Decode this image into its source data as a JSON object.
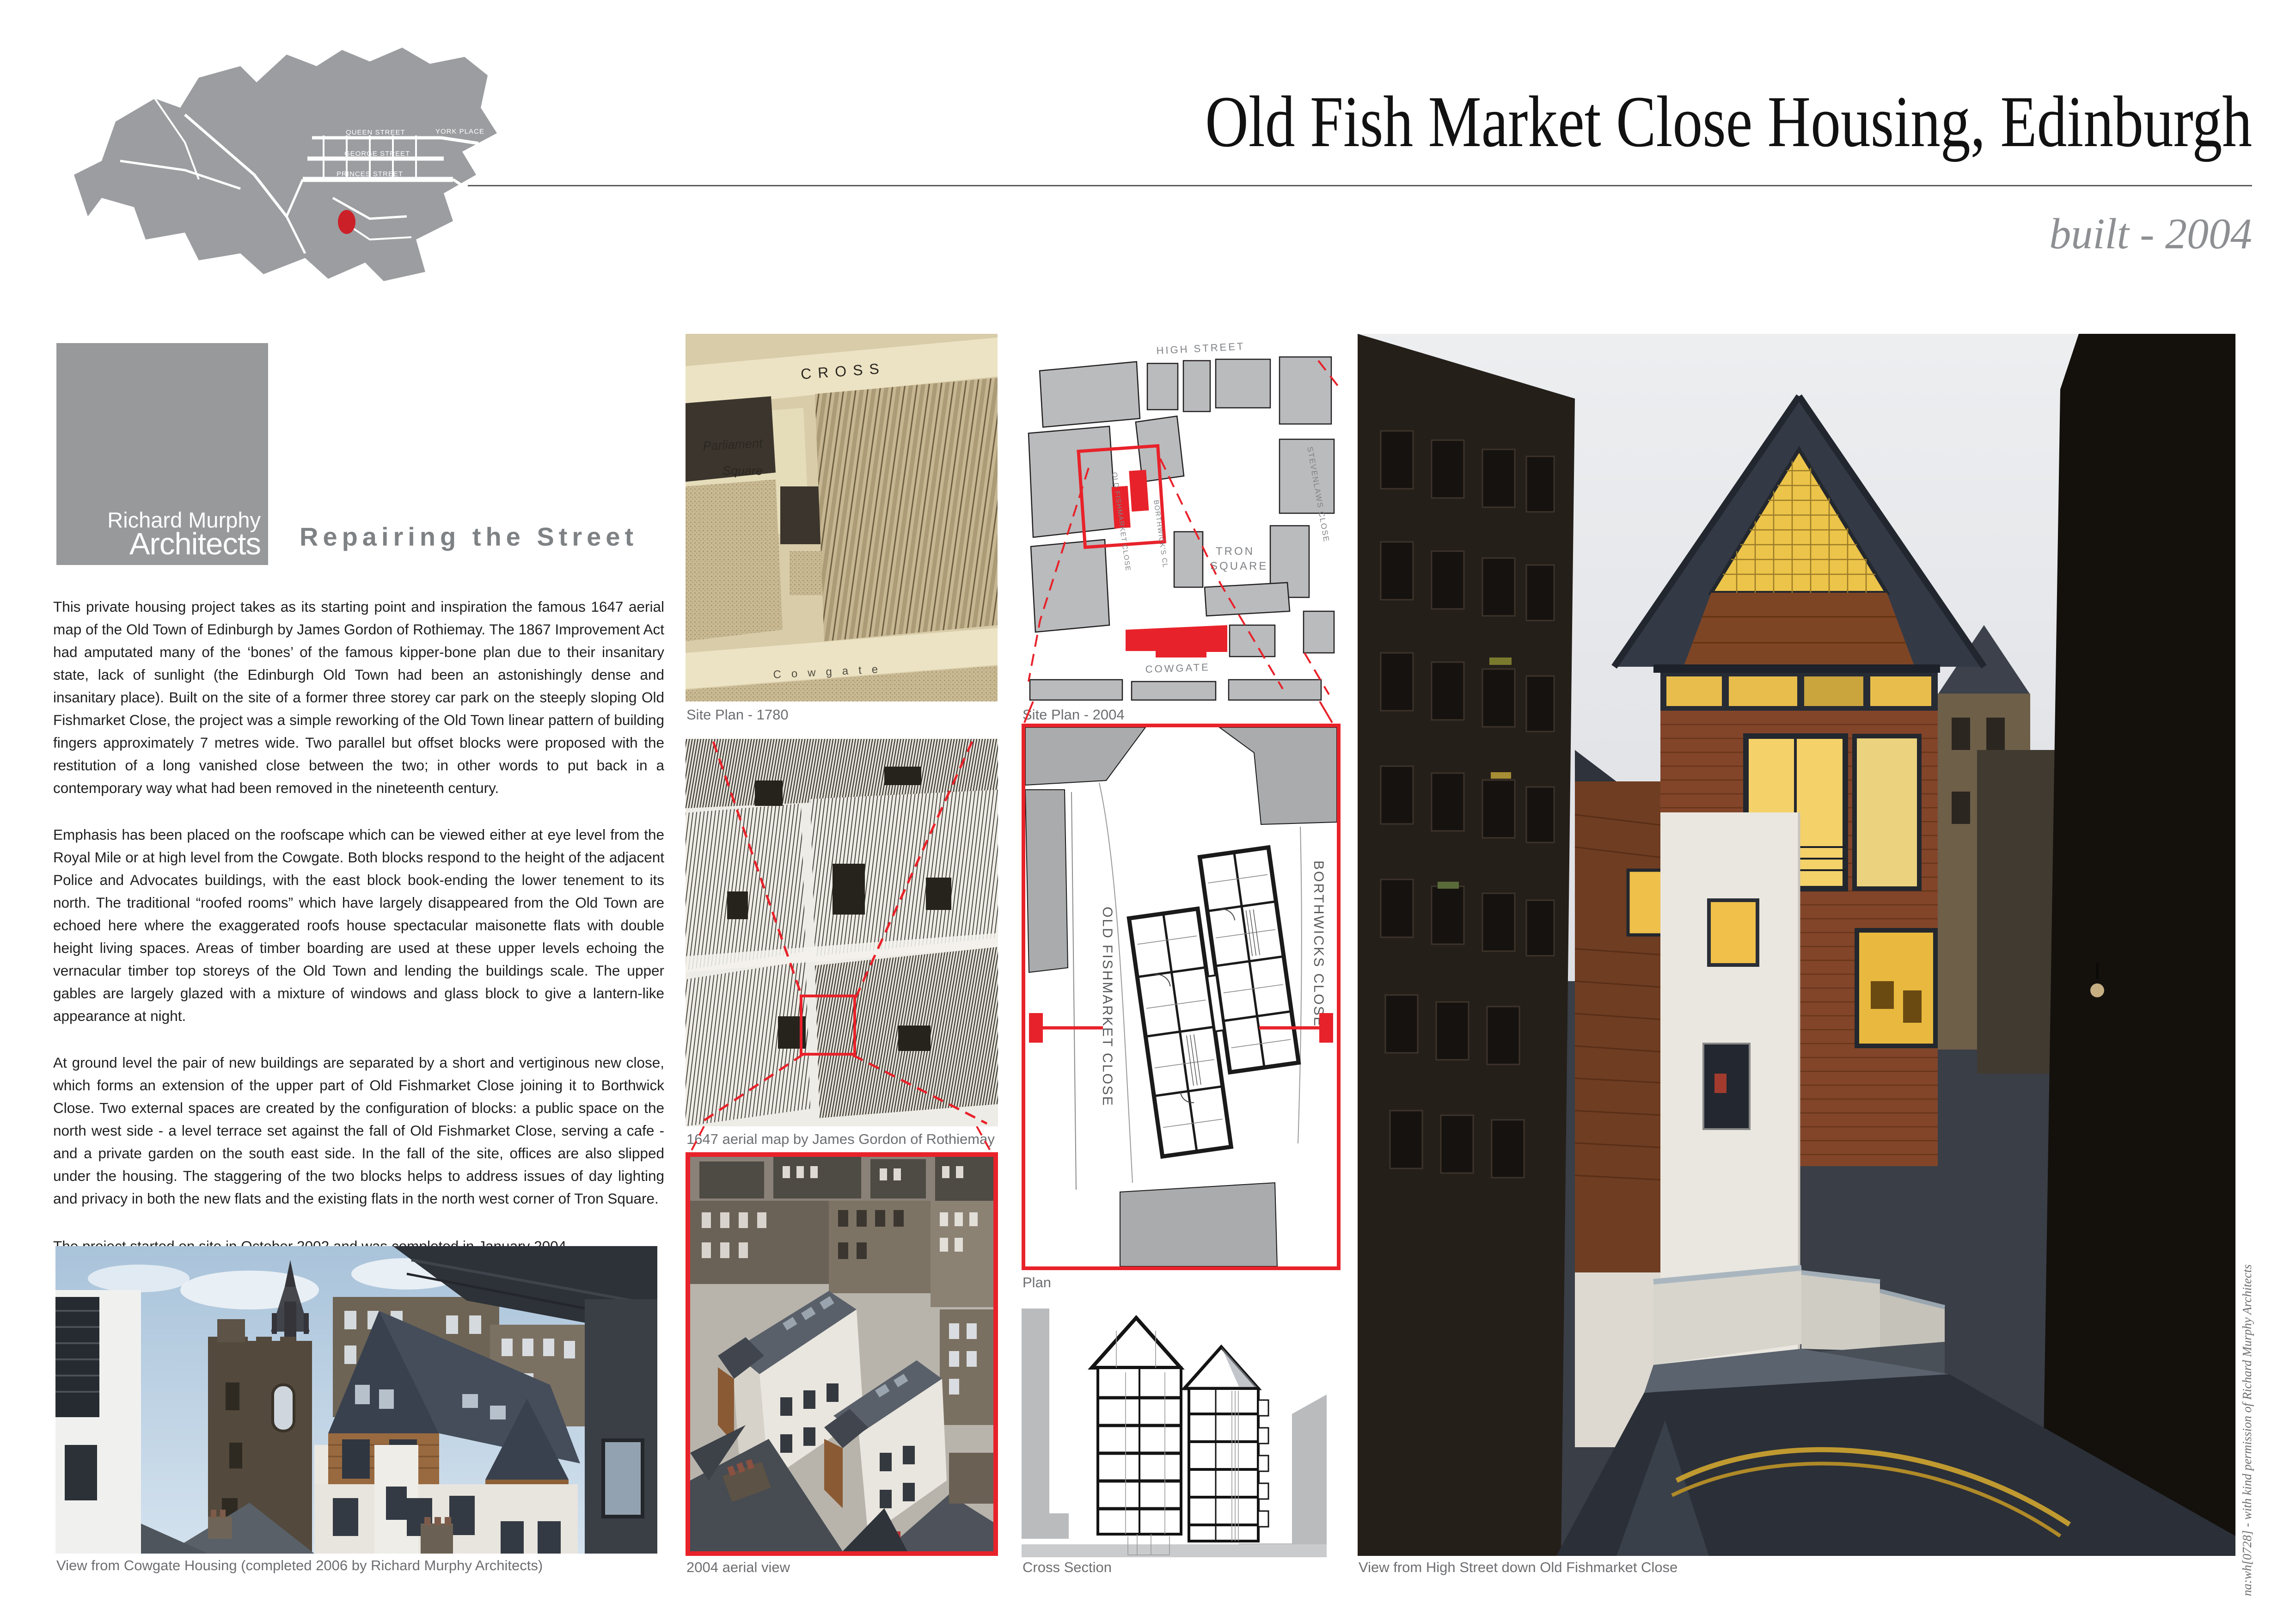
{
  "page": {
    "title": "Old Fish Market Close Housing, Edinburgh",
    "built": "built - 2004"
  },
  "logo": {
    "line1": "Richard Murphy",
    "line2": "Architects"
  },
  "heading": "Repairing the Street",
  "body": {
    "p1": "This private housing project takes as its starting point and inspiration the famous 1647 aerial map of the Old Town of Edinburgh by James Gordon of Rothiemay.  The 1867 Improvement Act had amputated many of the ‘bones’ of the famous kipper-bone plan due to their insanitary state, lack of sunlight (the Edinburgh Old Town had been an astonishingly dense and insanitary place). Built on the site of a former three storey car park on the steeply sloping Old Fishmarket Close, the project was a simple reworking of the Old Town linear pattern of building fingers approximately 7 metres wide.  Two parallel but offset blocks were proposed with the restitution of a long vanished close between the two; in other words to put back in a contemporary way what had been removed in the nineteenth century.",
    "p2": "Emphasis has been placed on the roofscape which can be viewed either at eye level from the Royal Mile or at high level from the Cowgate. Both blocks respond to the height of the adjacent Police and Advocates buildings, with the east block book-ending the lower tenement to its north.  The traditional “roofed rooms” which have largely disappeared from the Old Town are echoed here where the exaggerated roofs house spectacular maisonette flats with double height living spaces. Areas of timber boarding are used at these upper levels echoing the vernacular timber top storeys of the Old Town and lending the buildings scale.  The upper gables are largely glazed with a mixture of windows and glass block to give a lantern-like appearance at night.",
    "p3": "At ground level the pair of new buildings are separated by a short and vertiginous new close, which forms an extension of the upper part of Old Fishmarket Close joining it to Borthwick Close.  Two external spaces are created by the configuration of blocks: a public space on the north west side - a level terrace set against the fall of Old Fishmarket Close, serving a cafe - and a private garden on the south east side. In the fall of the site, offices are also slipped under the housing.  The staggering of the two blocks helps to address issues of day lighting and privacy in both the new flats and the existing flats in the north west corner of Tron Square.",
    "p4": "The project started on site in October 2002 and was completed in January 2004."
  },
  "captions": {
    "site_plan_1780": "Site Plan - 1780",
    "site_plan_2004": "Site Plan - 2004",
    "aerial_1647": "1647 aerial map by James Gordon of Rothiemay",
    "plan": "Plan",
    "aerial_2004": "2004 aerial view",
    "cross_section": "Cross Section",
    "cowgate_view": "View from Cowgate Housing (completed 2006 by Richard Murphy Architects)",
    "high_street_view": "View from High Street down Old Fishmarket Close",
    "photo_credit": "na:wh[0728] - with kind permission of Richard Murphy Architects"
  },
  "locator_map": {
    "streets": [
      "QUEEN STREET",
      "GEORGE STREET",
      "PRINCES STREET",
      "YORK PLACE"
    ]
  },
  "site_plan_2004_labels": {
    "high_street": "HIGH STREET",
    "cowgate": "COWGATE",
    "tron": "TRON",
    "square": "SQUARE",
    "stevenlaws": "STEVENLAWS CLOSE",
    "old_fishmarket": "OLD FISHMARKET CLOSE",
    "borthwicks": "BORTHWICK'S CL"
  },
  "plan_labels": {
    "old_fishmarket": "OLD FISHMARKET CLOSE",
    "borthwicks": "BORTHWICKS CLOSE"
  },
  "map_1780_labels": {
    "cross": "CROSS",
    "parliament": "Parliament",
    "square": "Square",
    "cowgate": "Cowgate"
  },
  "colors": {
    "accent_red": "#e8222a",
    "logo_gray": "#97999b",
    "caption_gray": "#6d6e71",
    "heading_gray": "#7f8285",
    "built_gray": "#8d8f92"
  }
}
